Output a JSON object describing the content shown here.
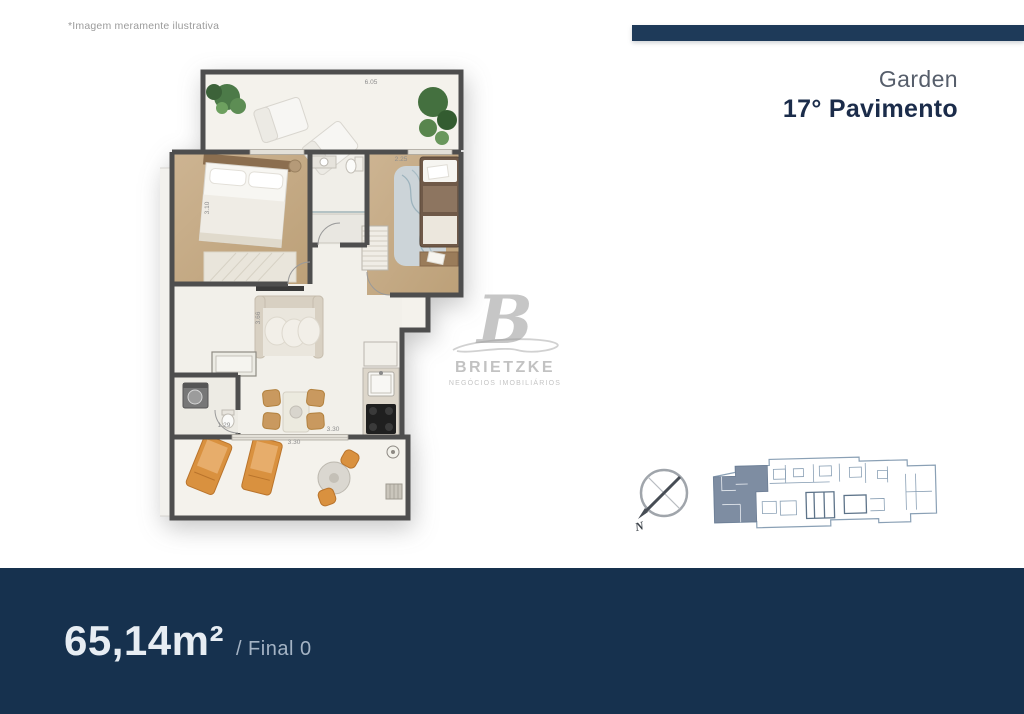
{
  "page": {
    "disclaimer": "*Imagem meramente ilustrativa"
  },
  "header": {
    "subtitle": "Garden",
    "title": "17° Pavimento"
  },
  "plan": {
    "dimensions": {
      "terrace_top_width": "6.05",
      "bedroom2_width": "2.25",
      "bedroom1_depth": "3.10",
      "living_depth": "3.66",
      "bath_door_width": "1.29",
      "dining_width": "3.30",
      "terrace_bottom_width": "3.30"
    }
  },
  "watermark": {
    "initial": "B",
    "brand": "BRIETZKE",
    "tagline": "NEGÓCIOS IMOBILIÁRIOS"
  },
  "compass": {
    "north_label": "N"
  },
  "footer": {
    "area": "65,14m²",
    "final": "/ Final 0"
  },
  "colors": {
    "navy_footer": "#16314e",
    "navy_accent_bar": "#1e3a59",
    "title_navy": "#1b2c4a",
    "wall_gray": "#4e4e4e",
    "wood_floor": "#c8ae8c",
    "orange_furniture": "#d9913f",
    "keyplan_highlight": "#7e8da2",
    "keyplan_line": "#8aa0b5"
  }
}
